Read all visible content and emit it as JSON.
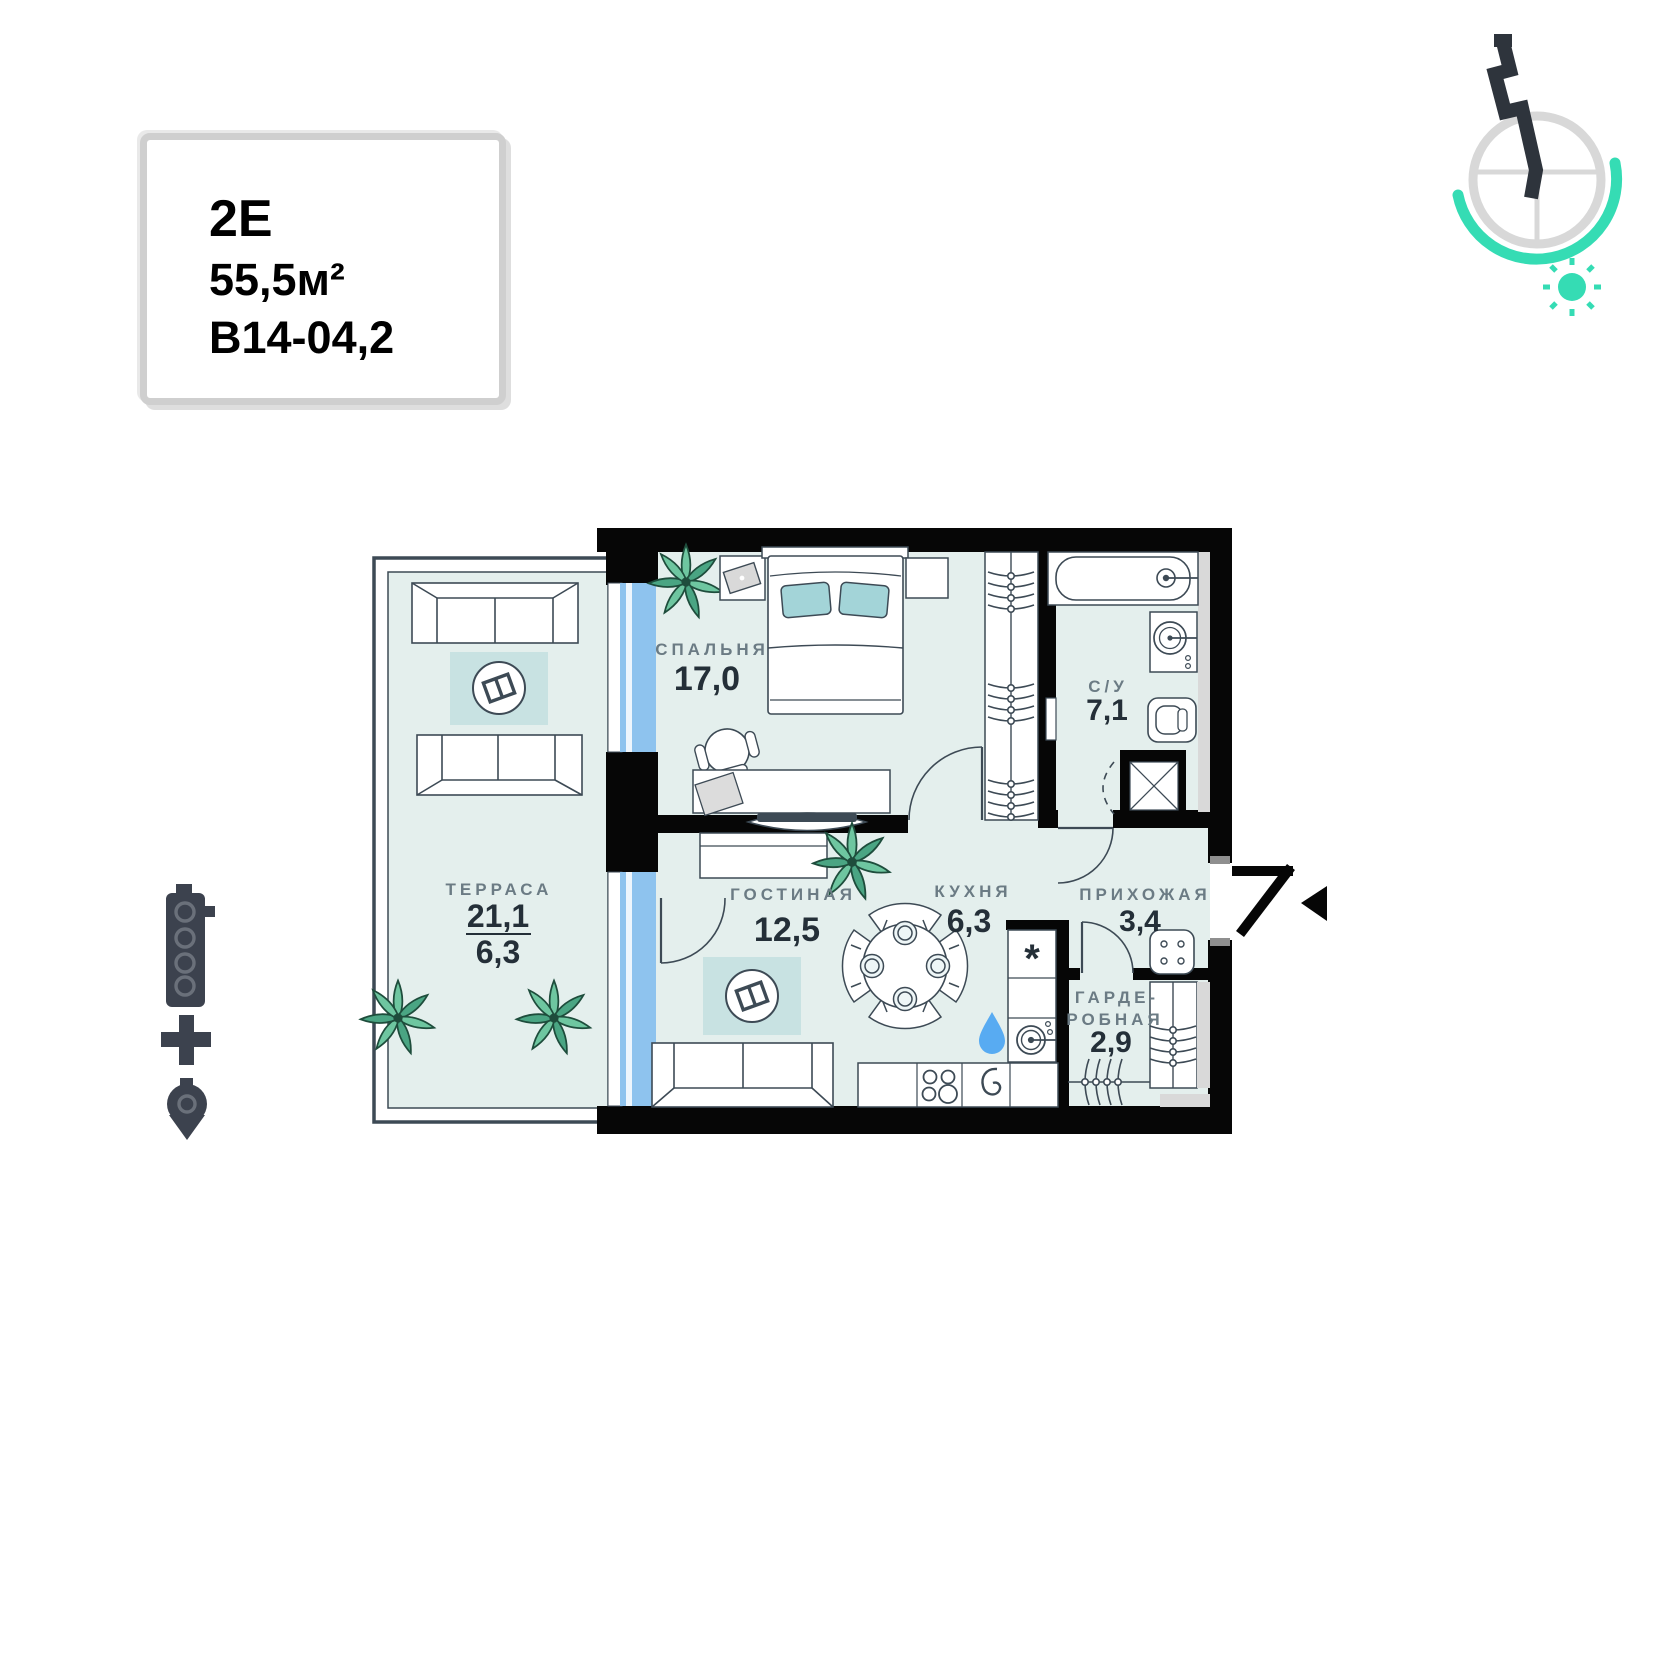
{
  "unit_card": {
    "type_label": "2Е",
    "area_label": "55,5м²",
    "unit_number": "В14-04,2"
  },
  "rooms": {
    "bedroom": {
      "name": "СПАЛЬНЯ",
      "area": "17,0"
    },
    "bathroom": {
      "name": "С/У",
      "area": "7,1"
    },
    "terrace": {
      "name": "ТЕРРАСА",
      "area_total": "21,1",
      "area_reduced": "6,3"
    },
    "living": {
      "name": "ГОСТИНАЯ",
      "area": "12,5"
    },
    "kitchen": {
      "name": "КУХНЯ",
      "area": "6,3"
    },
    "hallway": {
      "name": "ПРИХОЖАЯ",
      "area": "3,4"
    },
    "wardrobe": {
      "name_line1": "ГАРДЕ-",
      "name_line2": "РОБНАЯ",
      "area": "2,9"
    }
  },
  "symbols": {
    "washer_mark": "*"
  },
  "icons": {
    "logo": "compass-sun-logo",
    "left_group": [
      "building-icon",
      "plus-icon",
      "location-pin-icon"
    ],
    "entrance": "entrance-arrow-icon"
  },
  "colors": {
    "accent_teal": "#35dcb4",
    "window_blue": "#8ec3ee",
    "room_fill": "#e4efed",
    "rug": "#c8e2e2",
    "pillow": "#a3d4d8",
    "plant": "#6ec6a0",
    "wall": "#060606",
    "furniture_line": "#3d4a55",
    "label_gray": "#6b7b84",
    "number_dark": "#242f38",
    "water_drop": "#58abf2"
  }
}
